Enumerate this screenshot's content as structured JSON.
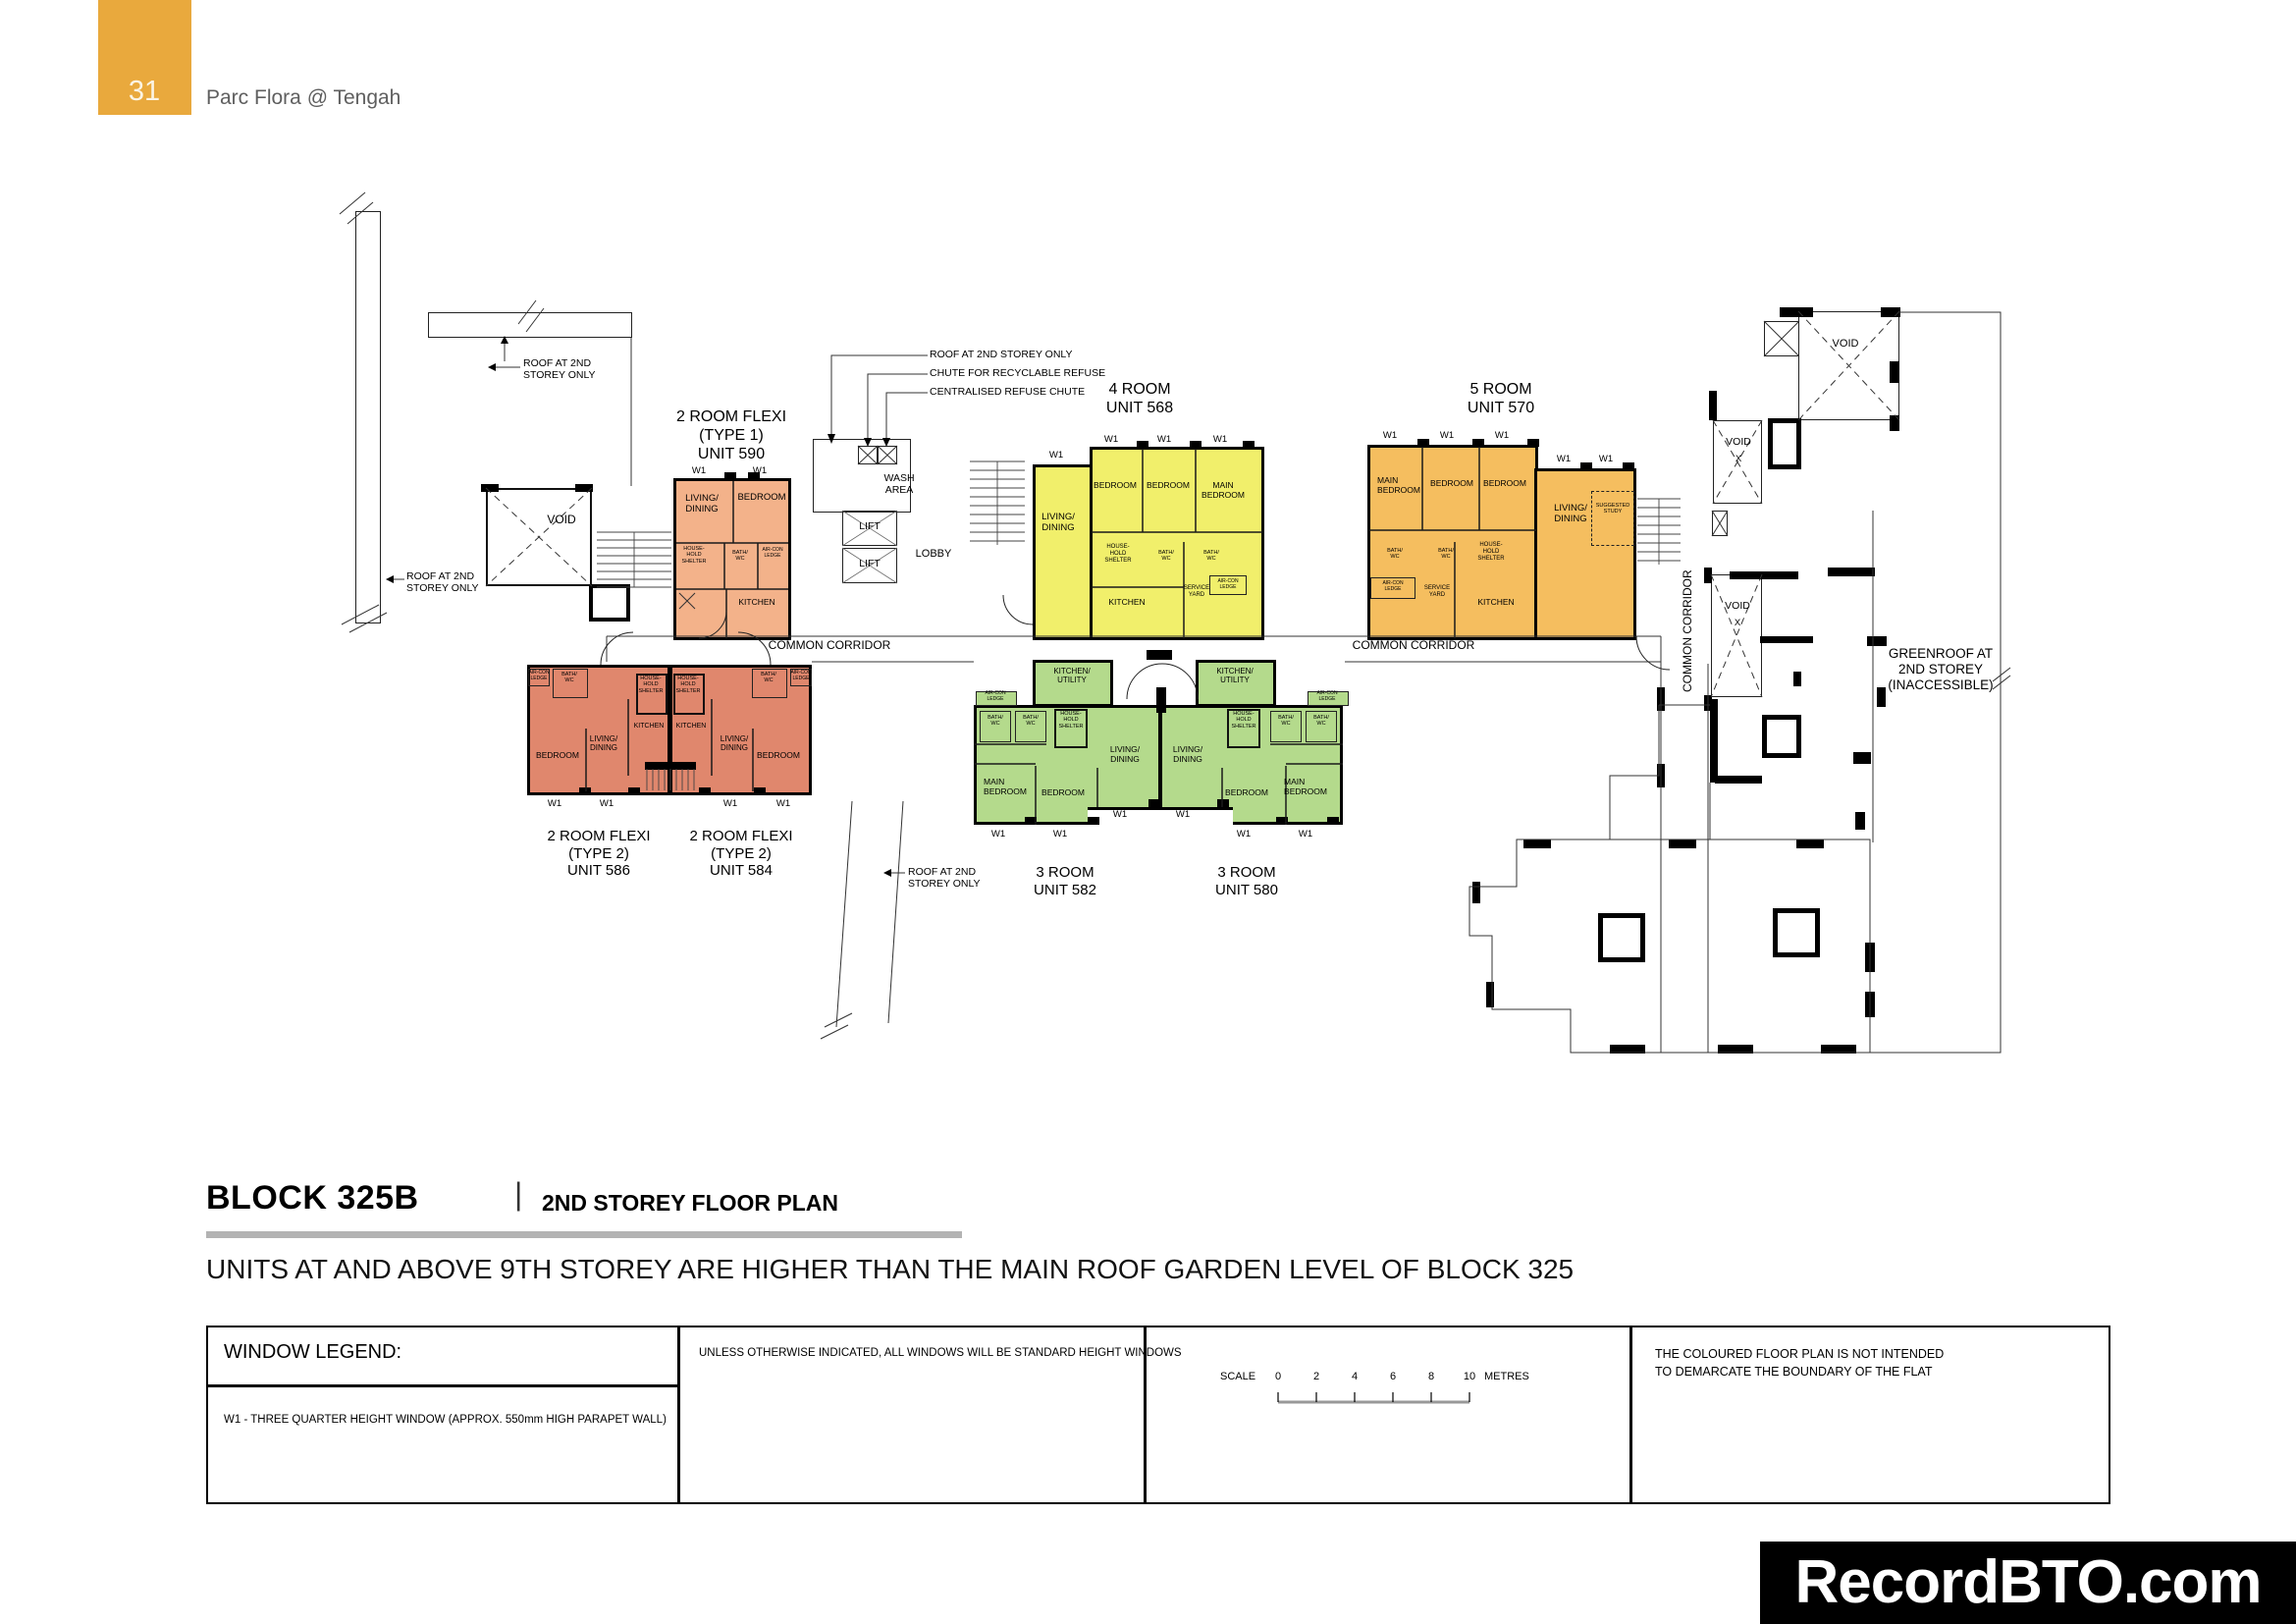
{
  "header": {
    "page_number": "31",
    "project_name": "Parc Flora @ Tengah"
  },
  "plan": {
    "units": {
      "u590": {
        "l1": "2 ROOM FLEXI",
        "l2": "(TYPE 1)",
        "l3": "UNIT 590"
      },
      "u568": {
        "l1": "4 ROOM",
        "l2": "UNIT 568"
      },
      "u570": {
        "l1": "5 ROOM",
        "l2": "UNIT 570"
      },
      "u586": {
        "l1": "2 ROOM FLEXI",
        "l2": "(TYPE 2)",
        "l3": "UNIT 586"
      },
      "u584": {
        "l1": "2 ROOM FLEXI",
        "l2": "(TYPE 2)",
        "l3": "UNIT 584"
      },
      "u582": {
        "l1": "3 ROOM",
        "l2": "UNIT 582"
      },
      "u580": {
        "l1": "3 ROOM",
        "l2": "UNIT 580"
      }
    },
    "rooms": {
      "living1": "LIVING/",
      "living2": "DINING",
      "bedroom": "BEDROOM",
      "main": "MAIN",
      "kitchen": "KITCHEN",
      "ku1": "KITCHEN/",
      "ku2": "UTILITY",
      "bath1": "BATH/",
      "bath2": "WC",
      "hh1": "HOUSE-",
      "hh2": "HOLD",
      "hh3": "SHELTER",
      "ac1": "AIR-CON",
      "ac2": "LEDGE",
      "sy1": "SERVICE",
      "sy2": "YARD",
      "study1": "SUGGESTED",
      "study2": "STUDY",
      "w1": "W1"
    },
    "areas": {
      "wash1": "WASH",
      "wash2": "AREA",
      "lift": "LIFT",
      "lobby": "LOBBY",
      "void": "VOID",
      "x": "X",
      "corridor": "COMMON CORRIDOR",
      "green1": "GREENROOF AT",
      "green2": "2ND STOREY",
      "green3": "(INACCESSIBLE)"
    },
    "annotations": {
      "roof_l1": "ROOF AT 2ND",
      "roof_l2": "STOREY ONLY",
      "roof_single": "ROOF AT 2ND STOREY ONLY",
      "chute_recyclable": "CHUTE FOR RECYCLABLE REFUSE",
      "chute_centralised": "CENTRALISED REFUSE CHUTE"
    }
  },
  "title": {
    "block": "BLOCK 325B",
    "separator": "|",
    "plan": "2ND STOREY FLOOR PLAN",
    "note": "UNITS AT AND ABOVE 9TH STOREY ARE HIGHER THAN THE MAIN ROOF GARDEN LEVEL OF BLOCK 325"
  },
  "legend": {
    "window_title": "WINDOW LEGEND:",
    "w1_definition": "W1 -   THREE QUARTER HEIGHT WINDOW (APPROX. 550mm HIGH PARAPET WALL)",
    "windows_note": "UNLESS OTHERWISE INDICATED,  ALL WINDOWS WILL BE STANDARD HEIGHT WINDOWS",
    "scale_label": "SCALE",
    "scale_ticks": [
      "0",
      "2",
      "4",
      "6",
      "8",
      "10"
    ],
    "scale_unit": "METRES",
    "coloured_note_l1": "THE COLOURED FLOOR PLAN IS NOT INTENDED",
    "coloured_note_l2": "TO DEMARCATE THE BOUNDARY OF THE FLAT"
  },
  "watermark": "RecordBTO.com",
  "colors": {
    "badge": "#E9A93D",
    "u590": "#F3B28A",
    "u568": "#F1EF6B",
    "u570": "#F5BE5F",
    "u586": "#E0876D",
    "u582": "#B4DA8C",
    "underline": "#B3B3B3"
  }
}
